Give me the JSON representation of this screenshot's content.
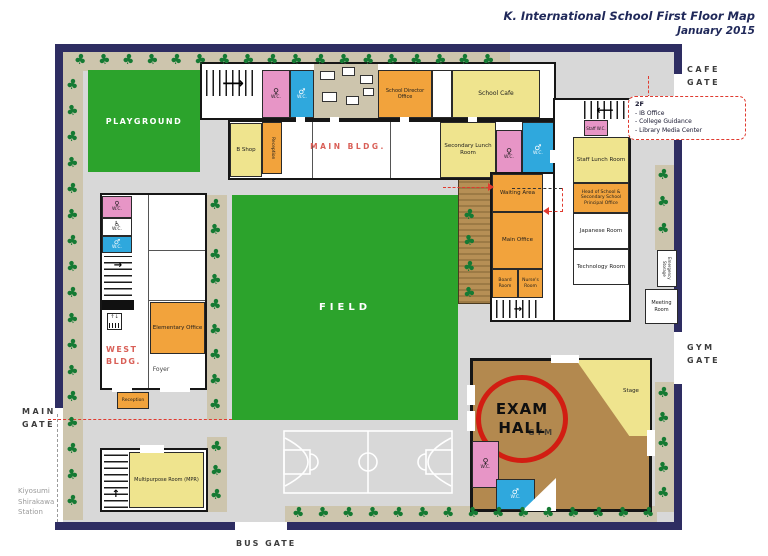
{
  "title": {
    "line1": "K. International School First Floor Map",
    "line2": "January 2015"
  },
  "gates": {
    "cafe": [
      "CAFE",
      "GATE"
    ],
    "gym": [
      "GYM",
      "GATE"
    ],
    "main": [
      "MAIN",
      "GATE"
    ],
    "bus": "BUS GATE"
  },
  "station": [
    "Kiyosumi",
    "Shirakawa",
    "Station"
  ],
  "annotation_2f": {
    "heading": "2F",
    "items": [
      "- IB Office",
      "- College Guidance",
      "- Library Media Center"
    ]
  },
  "exam_hall": [
    "EXAM",
    "HALL"
  ],
  "areas": {
    "playground": "PLAYGROUND",
    "field": "FIELD",
    "main_bldg": "MAIN BLDG.",
    "west_bldg": [
      "WEST",
      "BLDG."
    ],
    "gym": "GYM",
    "foyer": "Foyer"
  },
  "rooms": {
    "b_shop": "B Shop",
    "reception_entrance": "Reception",
    "school_director_office": "School Director Office",
    "school_cafe": "School Cafe",
    "secondary_lunch_room": "Secondary Lunch Room",
    "staff_wc": "Staff W.C.",
    "staff_lunch_room": "Staff Lunch Room",
    "head_of_school_office": "Head of School & Secondary School Principal Office",
    "japanese_room": "Japanese Room",
    "technology_room": "Technology Room",
    "waiting_area": "Waiting Area",
    "main_office": "Main Office",
    "board_room": "Board Room",
    "nurses_room": "Nurse's Room",
    "meeting_room": "Meeting Room",
    "emergency_storage": "Emergency Storage",
    "elementary_office": "Elementary Office",
    "reception": "Reception",
    "multipurpose_room": "Multipurpose Room (MPR)",
    "stage": "Stage"
  },
  "labels": {
    "wc": "W.C."
  },
  "icons": {
    "tree": "♣",
    "female": "♀",
    "male": "♂",
    "wheelchair": "♿",
    "elevator": "↑↓",
    "arrow_right": "⟶",
    "arrow_left": "⟵",
    "arrow_up": "↑",
    "arrow_right_small": "→"
  },
  "colors": {
    "border_navy": "#2e2d62",
    "ground_gray": "#d8d8d8",
    "tree_green": "#157a33",
    "grass_green": "#2ca32c",
    "tan": "#cdc5ad",
    "room_orange": "#f2a33c",
    "room_yellow": "#efe48e",
    "wc_pink": "#e795c6",
    "wc_blue": "#2fa8dd",
    "gym_brown": "#b3894f",
    "annotation_red": "#d21d12",
    "label_red": "#d95f57"
  }
}
